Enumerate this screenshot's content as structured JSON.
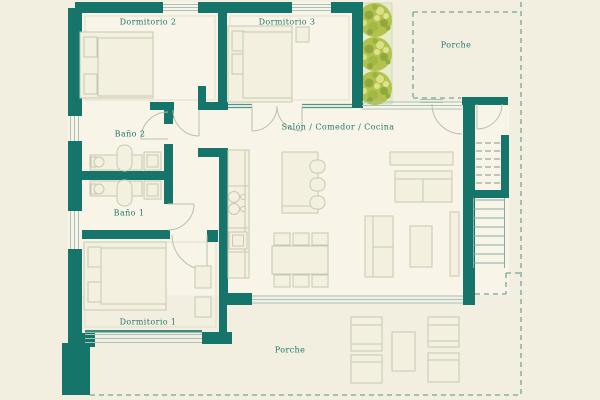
{
  "plan": {
    "type": "apartment-floor-plan",
    "rooms": [
      {
        "id": "dormitorio-2",
        "label": "Dormitorio 2"
      },
      {
        "id": "dormitorio-3",
        "label": "Dormitorio 3"
      },
      {
        "id": "porche-superior",
        "label": "Porche"
      },
      {
        "id": "bano-2",
        "label": "Baño 2"
      },
      {
        "id": "salon-comedor-cocina",
        "label": "Salón / Comedor / Cocina"
      },
      {
        "id": "bano-1",
        "label": "Baño 1"
      },
      {
        "id": "dormitorio-1",
        "label": "Dormitorio 1"
      },
      {
        "id": "porche-inferior",
        "label": "Porche"
      }
    ],
    "landscape": {
      "tree_count": 3
    }
  },
  "colors": {
    "wall": "#15756b",
    "floor": "#f8f5e8",
    "background": "#f2eee0",
    "label_text": "#22776b",
    "boundary_dash": "#74a69a",
    "tree": "#b3c24c",
    "hedge": "#e6ebcb",
    "furniture_line": "#c6c8b2"
  }
}
